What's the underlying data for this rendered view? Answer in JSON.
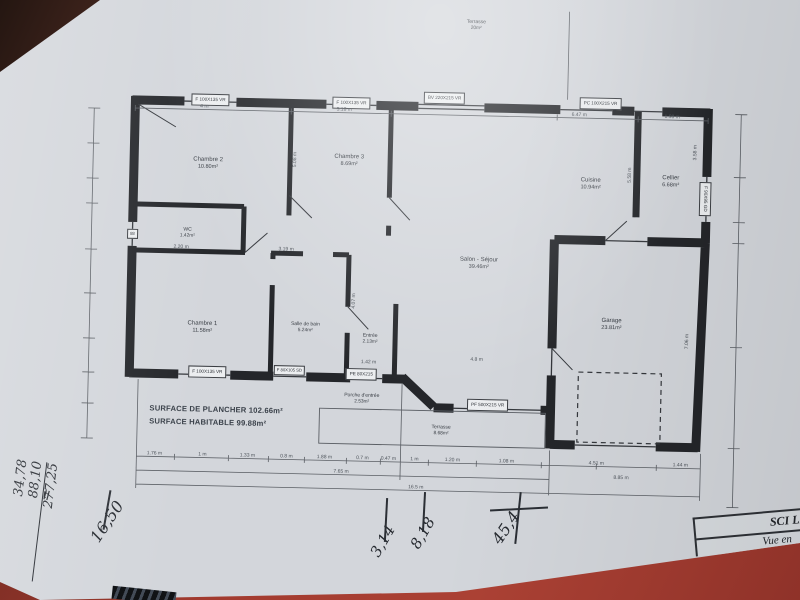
{
  "plan": {
    "rooms": [
      {
        "name": "Chambre 2",
        "area": "10.80m²"
      },
      {
        "name": "Chambre 3",
        "area": "8.69m²"
      },
      {
        "name": "Cuisine",
        "area": "10.94m²"
      },
      {
        "name": "Cellier",
        "area": "6.68m²"
      },
      {
        "name": "WC",
        "area": "1.42m²"
      },
      {
        "name": "Salon - Séjour",
        "area": "39.46m²"
      },
      {
        "name": "Chambre 1",
        "area": "11.58m²"
      },
      {
        "name": "Salle de bain",
        "area": "5.24m²"
      },
      {
        "name": "Entrée",
        "area": "2.13m²"
      },
      {
        "name": "Garage",
        "area": "23.81m²"
      },
      {
        "name": "Porche d'entrée",
        "area": "2.53m²"
      },
      {
        "name": "Terrasse",
        "area": "8.68m²"
      },
      {
        "name": "Terrasse",
        "area": "20m²"
      }
    ],
    "openings": {
      "top_window_1": "F 100X135 VR",
      "top_window_2": "F 100X135 VR",
      "bay_window": "BV 220X215 VR",
      "kitchen_door": "PC 100X215 VR",
      "cellier_window": "F 90X95 GD",
      "left_window": "88",
      "bottom_window_1": "F 100X135 VR",
      "bathroom_window": "F 80X105 SD",
      "entry_door": "PE 80X215",
      "sliding_bay": "PF 500X215 VR"
    },
    "surfaces": {
      "line1": "SURFACE DE PLANCHER 102.66m²",
      "line2": "SURFACE HABITABLE 99.88m²"
    },
    "dimensions": {
      "top": [
        "4 m",
        "5.18 m",
        "6.47 m",
        "1.98 m"
      ],
      "vertical": [
        "5.08 m",
        "5.58 m",
        "3.58 m",
        "7.06 m",
        "4.07 m"
      ],
      "interior": [
        "2.20 m",
        "3.19 m",
        "1.42 m",
        "4.8 m"
      ],
      "bottom_row1": [
        "1.76 m",
        "1 m",
        "1.33 m",
        "0.8 m",
        "1.88 m",
        "0.7 m",
        "0.47 m",
        "1 m",
        "1.20 m",
        "1.08 m",
        "4.51 m",
        "1.44 m"
      ],
      "bottom_row2": [
        "7.65 m",
        "8.85 m"
      ],
      "bottom_total": "16.5 m"
    }
  },
  "title_block": {
    "company": "SCI LES",
    "view": "Vue en"
  },
  "handwriting": {
    "equals": "=",
    "left_calc": [
      "34,78",
      "88,10",
      "277,25"
    ],
    "num1": "16,50",
    "num2": "3,14",
    "num3": "8,18",
    "num4": "45,4"
  },
  "colors": {
    "table": "#a23b2f",
    "paper": "#d3d6db",
    "wall": "#24262a"
  }
}
